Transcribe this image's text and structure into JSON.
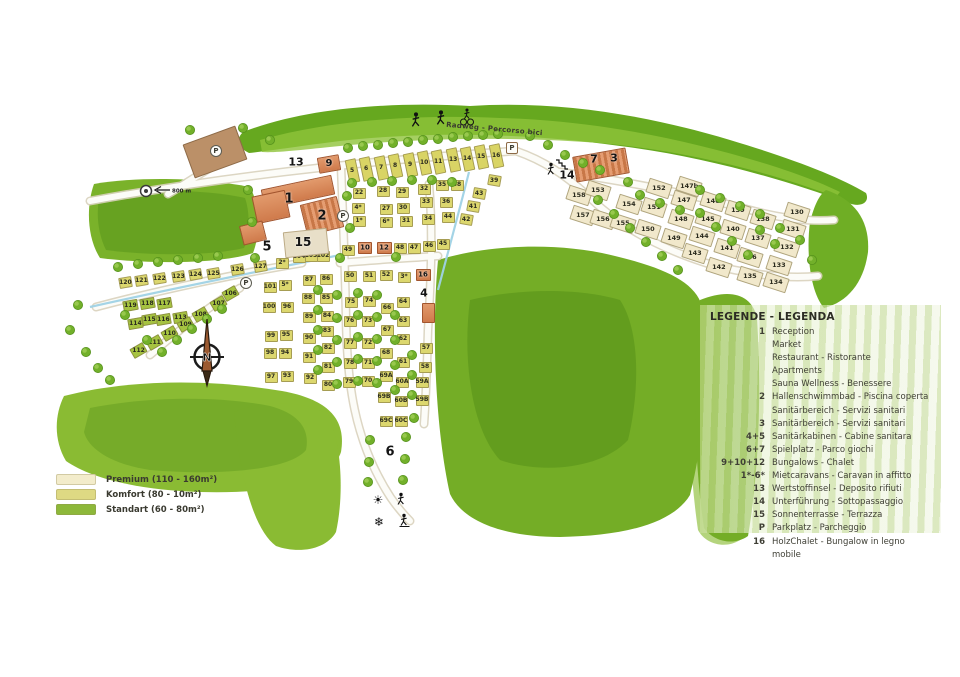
{
  "map": {
    "bike_path_label": "Radweg - Percorso bici",
    "distance_sign_label": "800 m",
    "compass_label": "N",
    "parking_label": "P",
    "icons": {
      "sun": "☀",
      "snowflake": "❄"
    },
    "area_labels": [
      [
        "1",
        289,
        199,
        13
      ],
      [
        "2",
        322,
        216,
        13
      ],
      [
        "5",
        267,
        247,
        13
      ],
      [
        "15",
        303,
        242,
        12
      ],
      [
        "9",
        329,
        164,
        10
      ],
      [
        "13",
        296,
        162,
        11
      ],
      [
        "14",
        567,
        175,
        11
      ],
      [
        "4",
        424,
        293,
        11
      ],
      [
        "6",
        390,
        452,
        13
      ],
      [
        "7",
        594,
        159,
        11
      ],
      [
        "3",
        614,
        158,
        11
      ],
      [
        "10",
        365,
        248,
        7
      ],
      [
        "12",
        384,
        248,
        7
      ],
      [
        "16",
        423,
        275,
        7
      ]
    ],
    "buildings": [
      [
        215,
        152,
        56,
        36,
        -20,
        "brown"
      ],
      [
        298,
        192,
        72,
        20,
        -12,
        "orange"
      ],
      [
        271,
        207,
        34,
        28,
        -12,
        "orange"
      ],
      [
        322,
        216,
        38,
        32,
        -14,
        "pool"
      ],
      [
        253,
        233,
        24,
        20,
        -14,
        "orange"
      ],
      [
        306,
        243,
        44,
        26,
        -6,
        "terrace"
      ],
      [
        329,
        164,
        22,
        16,
        -10,
        "orange"
      ],
      [
        601,
        165,
        54,
        26,
        -10,
        "pool"
      ],
      [
        365,
        248,
        14,
        12,
        0,
        "orange"
      ],
      [
        384,
        248,
        15,
        12,
        0,
        "orange"
      ],
      [
        423,
        275,
        15,
        12,
        0,
        "orange"
      ],
      [
        428,
        313,
        13,
        20,
        0,
        "orange"
      ]
    ],
    "parking_markers": [
      [
        216,
        151,
        "circle"
      ],
      [
        343,
        216,
        "circle"
      ],
      [
        246,
        283,
        "circle"
      ],
      [
        512,
        148,
        "square"
      ]
    ],
    "plots": [
      [
        "5",
        352,
        171,
        "t",
        -12
      ],
      [
        "6",
        366,
        169,
        "t",
        -12
      ],
      [
        "7",
        381,
        168,
        "t",
        -12
      ],
      [
        "8",
        395,
        166,
        "t",
        -12
      ],
      [
        "9",
        410,
        165,
        "t",
        -12
      ],
      [
        "10",
        424,
        163,
        "t",
        -12
      ],
      [
        "11",
        438,
        162,
        "t",
        -12
      ],
      [
        "13",
        453,
        160,
        "t",
        -12
      ],
      [
        "14",
        467,
        159,
        "t",
        -12
      ],
      [
        "15",
        481,
        157,
        "t",
        -12
      ],
      [
        "16",
        496,
        156,
        "t",
        -12
      ],
      [
        "22",
        359,
        193,
        "k",
        0
      ],
      [
        "4*",
        358,
        208,
        "k",
        0
      ],
      [
        "1*",
        359,
        221,
        "k",
        0
      ],
      [
        "28",
        383,
        191,
        "k",
        0
      ],
      [
        "27",
        386,
        209,
        "k",
        0
      ],
      [
        "6*",
        386,
        222,
        "k",
        0
      ],
      [
        "29",
        402,
        192,
        "k",
        0
      ],
      [
        "30",
        403,
        208,
        "k",
        0
      ],
      [
        "31",
        406,
        221,
        "k",
        0
      ],
      [
        "32",
        424,
        189,
        "k",
        0
      ],
      [
        "33",
        426,
        202,
        "k",
        0
      ],
      [
        "34",
        428,
        219,
        "k",
        0
      ],
      [
        "35",
        442,
        185,
        "k",
        0
      ],
      [
        "36",
        446,
        202,
        "k",
        0
      ],
      [
        "38",
        457,
        185,
        "k",
        0
      ],
      [
        "39",
        494,
        180,
        "k",
        10
      ],
      [
        "43",
        479,
        193,
        "k",
        10
      ],
      [
        "41",
        473,
        206,
        "k",
        10
      ],
      [
        "42",
        466,
        219,
        "k",
        10
      ],
      [
        "44",
        448,
        217,
        "k",
        0
      ],
      [
        "45",
        443,
        244,
        "k",
        0
      ],
      [
        "46",
        429,
        246,
        "k",
        0
      ],
      [
        "47",
        414,
        248,
        "k",
        0
      ],
      [
        "48",
        400,
        248,
        "k",
        0
      ],
      [
        "49",
        348,
        250,
        "k",
        0
      ],
      [
        "50",
        350,
        276,
        "k",
        0
      ],
      [
        "51",
        369,
        276,
        "k",
        0
      ],
      [
        "52",
        386,
        275,
        "k",
        0
      ],
      [
        "3*",
        404,
        277,
        "k",
        0
      ],
      [
        "104",
        299,
        257,
        "k",
        0
      ],
      [
        "103",
        311,
        256,
        "k",
        0
      ],
      [
        "102",
        323,
        256,
        "k",
        0
      ],
      [
        "127",
        260,
        266,
        "k",
        -10
      ],
      [
        "2*",
        282,
        263,
        "k",
        0
      ],
      [
        "126",
        237,
        269,
        "k",
        -10
      ],
      [
        "101",
        270,
        287,
        "k",
        0
      ],
      [
        "5*",
        285,
        285,
        "k",
        0
      ],
      [
        "100",
        269,
        307,
        "k",
        0
      ],
      [
        "96",
        287,
        307,
        "k",
        0
      ],
      [
        "99",
        271,
        336,
        "k",
        0
      ],
      [
        "95",
        286,
        335,
        "k",
        0
      ],
      [
        "98",
        270,
        353,
        "k",
        0
      ],
      [
        "94",
        285,
        353,
        "k",
        0
      ],
      [
        "97",
        271,
        377,
        "k",
        0
      ],
      [
        "93",
        287,
        376,
        "k",
        0
      ],
      [
        "87",
        309,
        280,
        "k",
        0
      ],
      [
        "86",
        326,
        279,
        "k",
        0
      ],
      [
        "88",
        308,
        298,
        "k",
        0
      ],
      [
        "85",
        326,
        298,
        "k",
        0
      ],
      [
        "89",
        309,
        317,
        "k",
        0
      ],
      [
        "84",
        327,
        316,
        "k",
        0
      ],
      [
        "90",
        309,
        338,
        "k",
        0
      ],
      [
        "83",
        327,
        331,
        "k",
        0
      ],
      [
        "82",
        328,
        348,
        "k",
        0
      ],
      [
        "91",
        309,
        357,
        "k",
        0
      ],
      [
        "81",
        328,
        367,
        "k",
        0
      ],
      [
        "92",
        310,
        378,
        "k",
        0
      ],
      [
        "80",
        328,
        385,
        "k",
        0
      ],
      [
        "75",
        351,
        302,
        "k",
        0
      ],
      [
        "74",
        369,
        301,
        "k",
        0
      ],
      [
        "76",
        350,
        321,
        "k",
        0
      ],
      [
        "73",
        368,
        321,
        "k",
        0
      ],
      [
        "77",
        350,
        343,
        "k",
        0
      ],
      [
        "72",
        368,
        343,
        "k",
        0
      ],
      [
        "78",
        350,
        363,
        "k",
        0
      ],
      [
        "71",
        368,
        363,
        "k",
        0
      ],
      [
        "79",
        349,
        382,
        "k",
        0
      ],
      [
        "70",
        368,
        381,
        "k",
        0
      ],
      [
        "66",
        387,
        308,
        "k",
        0
      ],
      [
        "64",
        403,
        302,
        "k",
        0
      ],
      [
        "67",
        387,
        330,
        "k",
        0
      ],
      [
        "63",
        403,
        321,
        "k",
        0
      ],
      [
        "68",
        386,
        353,
        "k",
        0
      ],
      [
        "62",
        403,
        339,
        "k",
        0
      ],
      [
        "61",
        403,
        362,
        "k",
        0
      ],
      [
        "69A",
        386,
        376,
        "k",
        0
      ],
      [
        "60A",
        402,
        382,
        "k",
        0
      ],
      [
        "69B",
        384,
        397,
        "k",
        0
      ],
      [
        "60B",
        401,
        401,
        "k",
        0
      ],
      [
        "69C",
        386,
        421,
        "k",
        0
      ],
      [
        "60C",
        401,
        421,
        "k",
        0
      ],
      [
        "59A",
        422,
        382,
        "k",
        0
      ],
      [
        "59B",
        422,
        400,
        "k",
        0
      ],
      [
        "57",
        426,
        348,
        "k",
        0
      ],
      [
        "58",
        425,
        367,
        "k",
        0
      ],
      [
        "120",
        125,
        282,
        "k",
        -10
      ],
      [
        "121",
        141,
        280,
        "k",
        -10
      ],
      [
        "122",
        159,
        278,
        "k",
        -10
      ],
      [
        "123",
        178,
        276,
        "k",
        -10
      ],
      [
        "124",
        195,
        274,
        "k",
        -10
      ],
      [
        "125",
        213,
        273,
        "k",
        -10
      ],
      [
        "119",
        130,
        305,
        "s",
        -10
      ],
      [
        "118",
        147,
        303,
        "s",
        -10
      ],
      [
        "117",
        164,
        303,
        "s",
        -10
      ],
      [
        "116",
        163,
        319,
        "s",
        -10
      ],
      [
        "115",
        149,
        319,
        "s",
        -10
      ],
      [
        "114",
        135,
        323,
        "s",
        -10
      ],
      [
        "113",
        180,
        317,
        "s",
        -10
      ],
      [
        "106",
        230,
        293,
        "s",
        -30
      ],
      [
        "107",
        218,
        303,
        "s",
        -30
      ],
      [
        "108",
        200,
        314,
        "s",
        -30
      ],
      [
        "109",
        185,
        324,
        "s",
        -30
      ],
      [
        "110",
        169,
        333,
        "s",
        -30
      ],
      [
        "111",
        154,
        342,
        "s",
        -30
      ],
      [
        "112",
        138,
        350,
        "s",
        -30
      ],
      [
        "158",
        579,
        195,
        "p",
        18
      ],
      [
        "153",
        598,
        190,
        "p",
        18
      ],
      [
        "157",
        583,
        215,
        "p",
        18
      ],
      [
        "156",
        603,
        219,
        "p",
        18
      ],
      [
        "155",
        623,
        223,
        "p",
        18
      ],
      [
        "154",
        629,
        204,
        "p",
        18
      ],
      [
        "152",
        659,
        188,
        "p",
        18
      ],
      [
        "151",
        654,
        207,
        "p",
        18
      ],
      [
        "150",
        648,
        229,
        "p",
        18
      ],
      [
        "149",
        674,
        238,
        "p",
        18
      ],
      [
        "148",
        681,
        219,
        "p",
        18
      ],
      [
        "147",
        684,
        200,
        "p",
        18
      ],
      [
        "147b",
        689,
        186,
        "p",
        18
      ],
      [
        "146",
        713,
        201,
        "p",
        18
      ],
      [
        "145",
        708,
        219,
        "p",
        18
      ],
      [
        "144",
        702,
        236,
        "p",
        18
      ],
      [
        "143",
        695,
        253,
        "p",
        18
      ],
      [
        "142",
        719,
        267,
        "p",
        18
      ],
      [
        "141",
        727,
        248,
        "p",
        18
      ],
      [
        "140",
        733,
        229,
        "p",
        18
      ],
      [
        "139",
        738,
        210,
        "p",
        18
      ],
      [
        "138",
        763,
        219,
        "p",
        18
      ],
      [
        "137",
        758,
        238,
        "p",
        18
      ],
      [
        "136",
        750,
        257,
        "p",
        18
      ],
      [
        "135",
        750,
        276,
        "p",
        18
      ],
      [
        "134",
        776,
        282,
        "p",
        18
      ],
      [
        "133",
        779,
        265,
        "p",
        18
      ],
      [
        "132",
        787,
        247,
        "p",
        18
      ],
      [
        "131",
        793,
        229,
        "p",
        18
      ],
      [
        "130",
        797,
        212,
        "p",
        18
      ]
    ]
  },
  "legend_panel": {
    "title": "LEGENDE - LEGENDA",
    "items": [
      {
        "key": "1",
        "lines": [
          "Reception",
          "Market",
          "Restaurant - Ristorante",
          "Apartments",
          "Sauna Wellness - Benessere"
        ]
      },
      {
        "key": "2",
        "lines": [
          "Hallenschwimmbad - Piscina coperta",
          "Sanitärbereich - Servizi sanitari"
        ]
      },
      {
        "key": "3",
        "lines": [
          "Sanitärbereich - Servizi sanitari"
        ]
      },
      {
        "key": "4+5",
        "lines": [
          "Sanitärkabinen - Cabine sanitara"
        ]
      },
      {
        "key": "6+7",
        "lines": [
          "Spielplatz - Parco giochi"
        ]
      },
      {
        "key": "9+10+12",
        "lines": [
          "Bungalows - Chalet"
        ]
      },
      {
        "key": "1*-6*",
        "lines": [
          "Mietcaravans - Caravan in affitto"
        ]
      },
      {
        "key": "13",
        "lines": [
          "Wertstoffinsel - Deposito rifiuti"
        ]
      },
      {
        "key": "14",
        "lines": [
          "Unterführung - Sottopassaggio"
        ]
      },
      {
        "key": "15",
        "lines": [
          "Sonnenterrasse - Terrazza"
        ]
      },
      {
        "key": "P",
        "lines": [
          "Parkplatz - Parcheggio"
        ]
      },
      {
        "key": "16",
        "lines": [
          "HolzChalet - Bungalow in legno mobile"
        ]
      }
    ]
  },
  "category_legend": {
    "items": [
      {
        "label": "Premium (110 - 160m²)",
        "color": "#f3eccb"
      },
      {
        "label": "Komfort (80 - 10m²)",
        "color": "#ded983"
      },
      {
        "label": "Standart (60 - 80m²)",
        "color": "#8db83a"
      }
    ]
  }
}
